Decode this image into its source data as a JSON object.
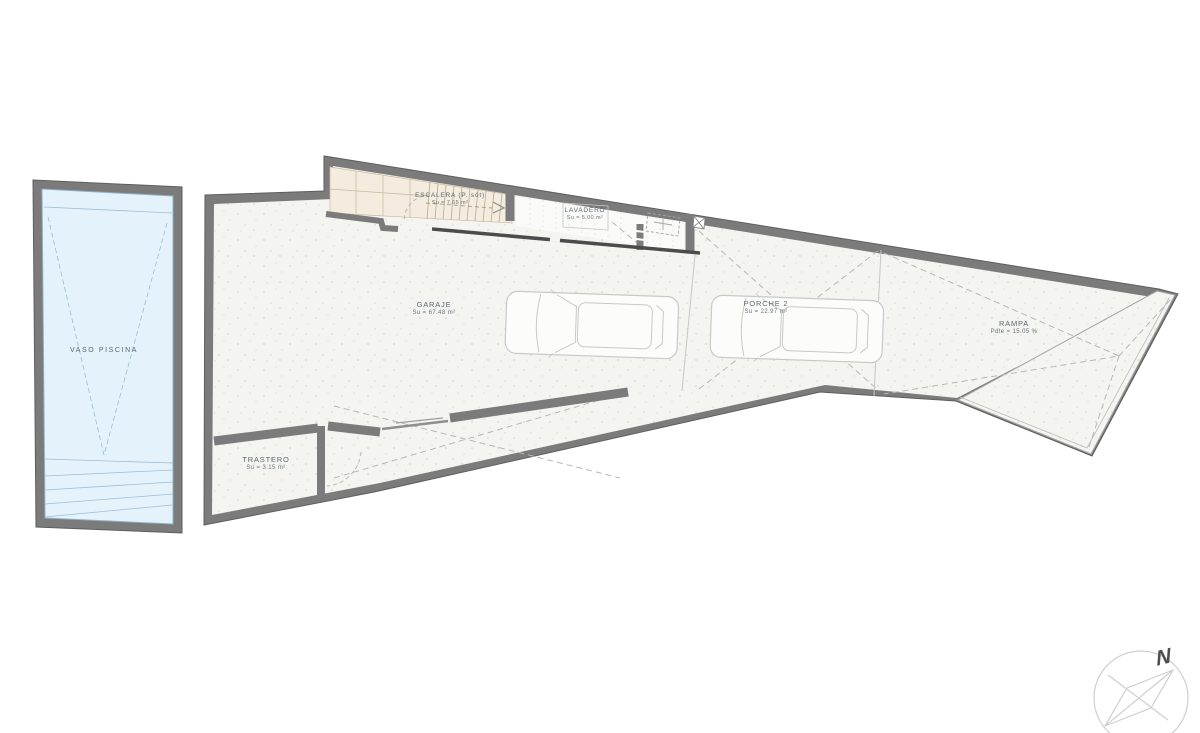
{
  "page": {
    "background": "#ffffff"
  },
  "plan": {
    "rooms": {
      "pool": {
        "name": "VASO PISCINA"
      },
      "escalera": {
        "name": "ESCALERA (P. sót)",
        "area": "Su = 7.65 m²"
      },
      "lavadero": {
        "name": "LAVADERO",
        "area": "Su = 5.00 m²"
      },
      "garaje": {
        "name": "GARAJE",
        "area": "Su = 67.48 m²"
      },
      "porche": {
        "name": "PORCHE 2",
        "area": "Su = 22.97 m²"
      },
      "rampa": {
        "name": "RAMPA",
        "area": "Pdte = 15.05 %"
      },
      "trastero": {
        "name": "TRASTERO",
        "area": "Su = 3.15 m²"
      }
    },
    "compass": {
      "north_label": "N"
    },
    "colors": {
      "wall": "#7b7b7b",
      "floor": "#f4f4f1",
      "pool_water": "#e4f2fc",
      "stair_tile": "#f3ecdf",
      "car_outline": "#c9c9c9",
      "label_text": "#5c6872"
    }
  }
}
